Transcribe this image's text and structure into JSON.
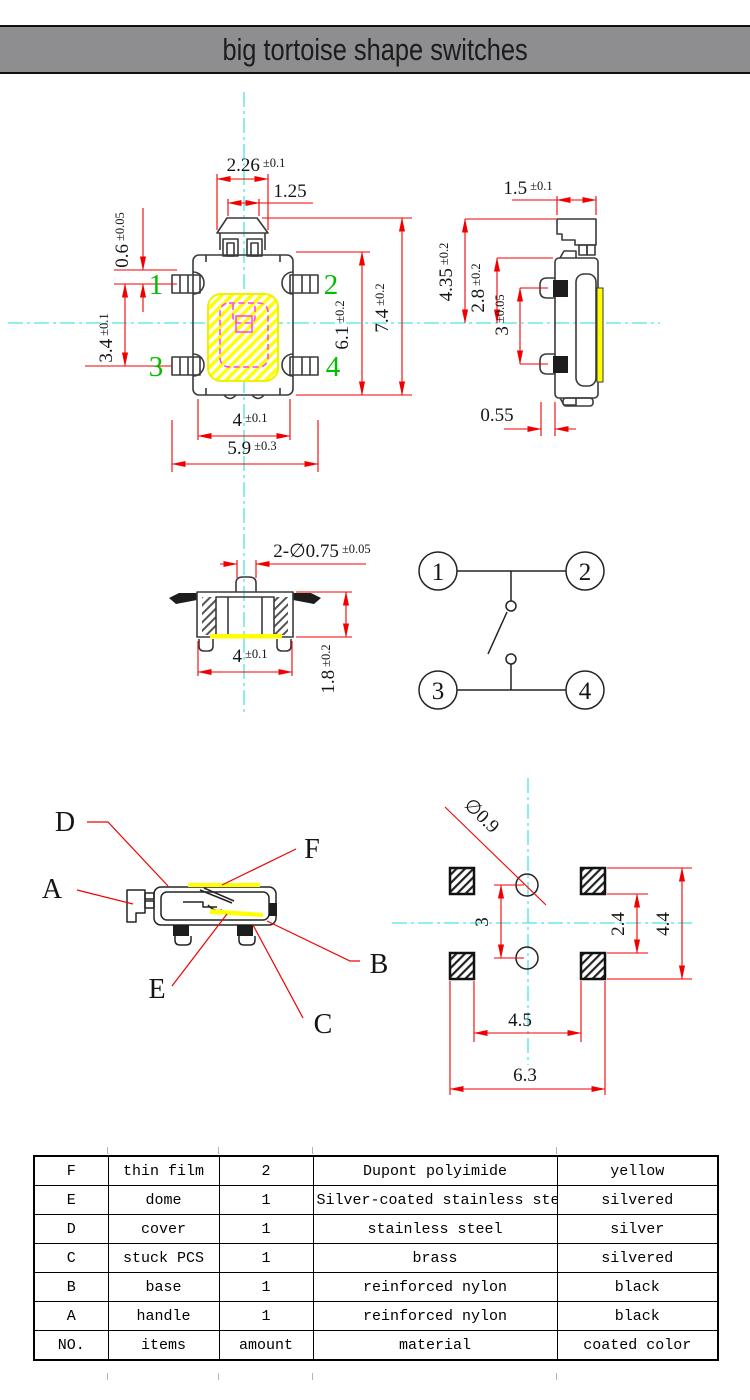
{
  "title": "big tortoise shape switches",
  "colors": {
    "dimension_red": "#f20000",
    "centerline_cyan": "#4ce4e4",
    "pin_green": "#00bf00",
    "film_yellow": "#ffff00",
    "contact_magenta": "#ff3dff",
    "titlebar_gray": "#8e8e90"
  },
  "front": {
    "cap_width": {
      "v": "2.26",
      "t": "±0.1"
    },
    "cap_top_width": {
      "v": "1.25"
    },
    "pin_top": {
      "v": "0.6",
      "t": "±0.05"
    },
    "pin_pitch": {
      "v": "3.4",
      "t": "±0.1"
    },
    "body_height": {
      "v": "6.1",
      "t": "±0.2"
    },
    "total_height": {
      "v": "7.4",
      "t": "±0.2"
    },
    "base_width": {
      "v": "4",
      "t": "±0.1"
    },
    "total_width": {
      "v": "5.9",
      "t": "±0.3"
    },
    "pins": [
      "1",
      "2",
      "3",
      "4"
    ]
  },
  "side": {
    "cap_width": {
      "v": "1.5",
      "t": "±0.1"
    },
    "total_height": {
      "v": "4.35",
      "t": "±0.2"
    },
    "upper_height": {
      "v": "2.8",
      "t": "±0.2"
    },
    "pin_pitch": {
      "v": "3",
      "t": "±0.05"
    },
    "pin_length": {
      "v": "0.55"
    }
  },
  "bottom": {
    "stem_holes": {
      "v": "2-∅0.75",
      "t": "±0.05"
    },
    "base_width": {
      "v": "4",
      "t": "±0.1"
    },
    "body_height": {
      "v": "1.8",
      "t": "±0.2"
    }
  },
  "schematic": {
    "terminals": [
      "1",
      "2",
      "3",
      "4"
    ]
  },
  "exploded": {
    "labels": [
      "A",
      "B",
      "C",
      "D",
      "E",
      "F"
    ]
  },
  "footprint": {
    "hole_dia": "∅0.9",
    "hole_pitch": "3",
    "pad_gap_v": "2.4",
    "pad_span_v": "4.4",
    "pad_inner_h": "4.5",
    "pad_outer_h": "6.3"
  },
  "table": {
    "rows": [
      [
        "F",
        "thin film",
        "2",
        "Dupont polyimide",
        "yellow"
      ],
      [
        "E",
        "dome",
        "1",
        "Silver-coated stainless steel",
        "silvered"
      ],
      [
        "D",
        "cover",
        "1",
        "stainless steel",
        "silver"
      ],
      [
        "C",
        "stuck PCS",
        "1",
        "brass",
        "silvered"
      ],
      [
        "B",
        "base",
        "1",
        "reinforced nylon",
        "black"
      ],
      [
        "A",
        "handle",
        "1",
        "reinforced nylon",
        "black"
      ],
      [
        "NO.",
        "items",
        "amount",
        "material",
        "coated color"
      ]
    ]
  }
}
